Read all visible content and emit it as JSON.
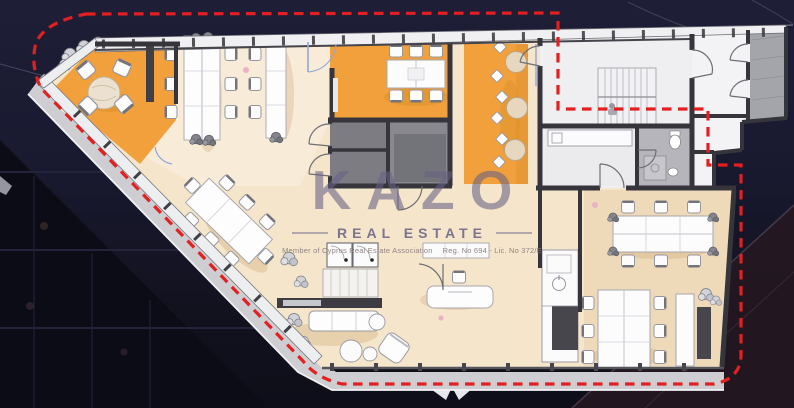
{
  "watermark": {
    "brand": "KAZO",
    "tagline": "REAL ESTATE",
    "membership": "Member of Cyprus Real Estate Association",
    "registration": "Reg. No 694 - Lic. No 372/E"
  },
  "colors": {
    "background": "#17172b",
    "floor": "#f5e6cb",
    "floor_dark": "#eed9b8",
    "accent_orange": "#f1a03c",
    "wall": "#35353b",
    "balcony": "#cdcdd2",
    "boundary_red": "#e31f1f",
    "watermark": "#666184"
  }
}
